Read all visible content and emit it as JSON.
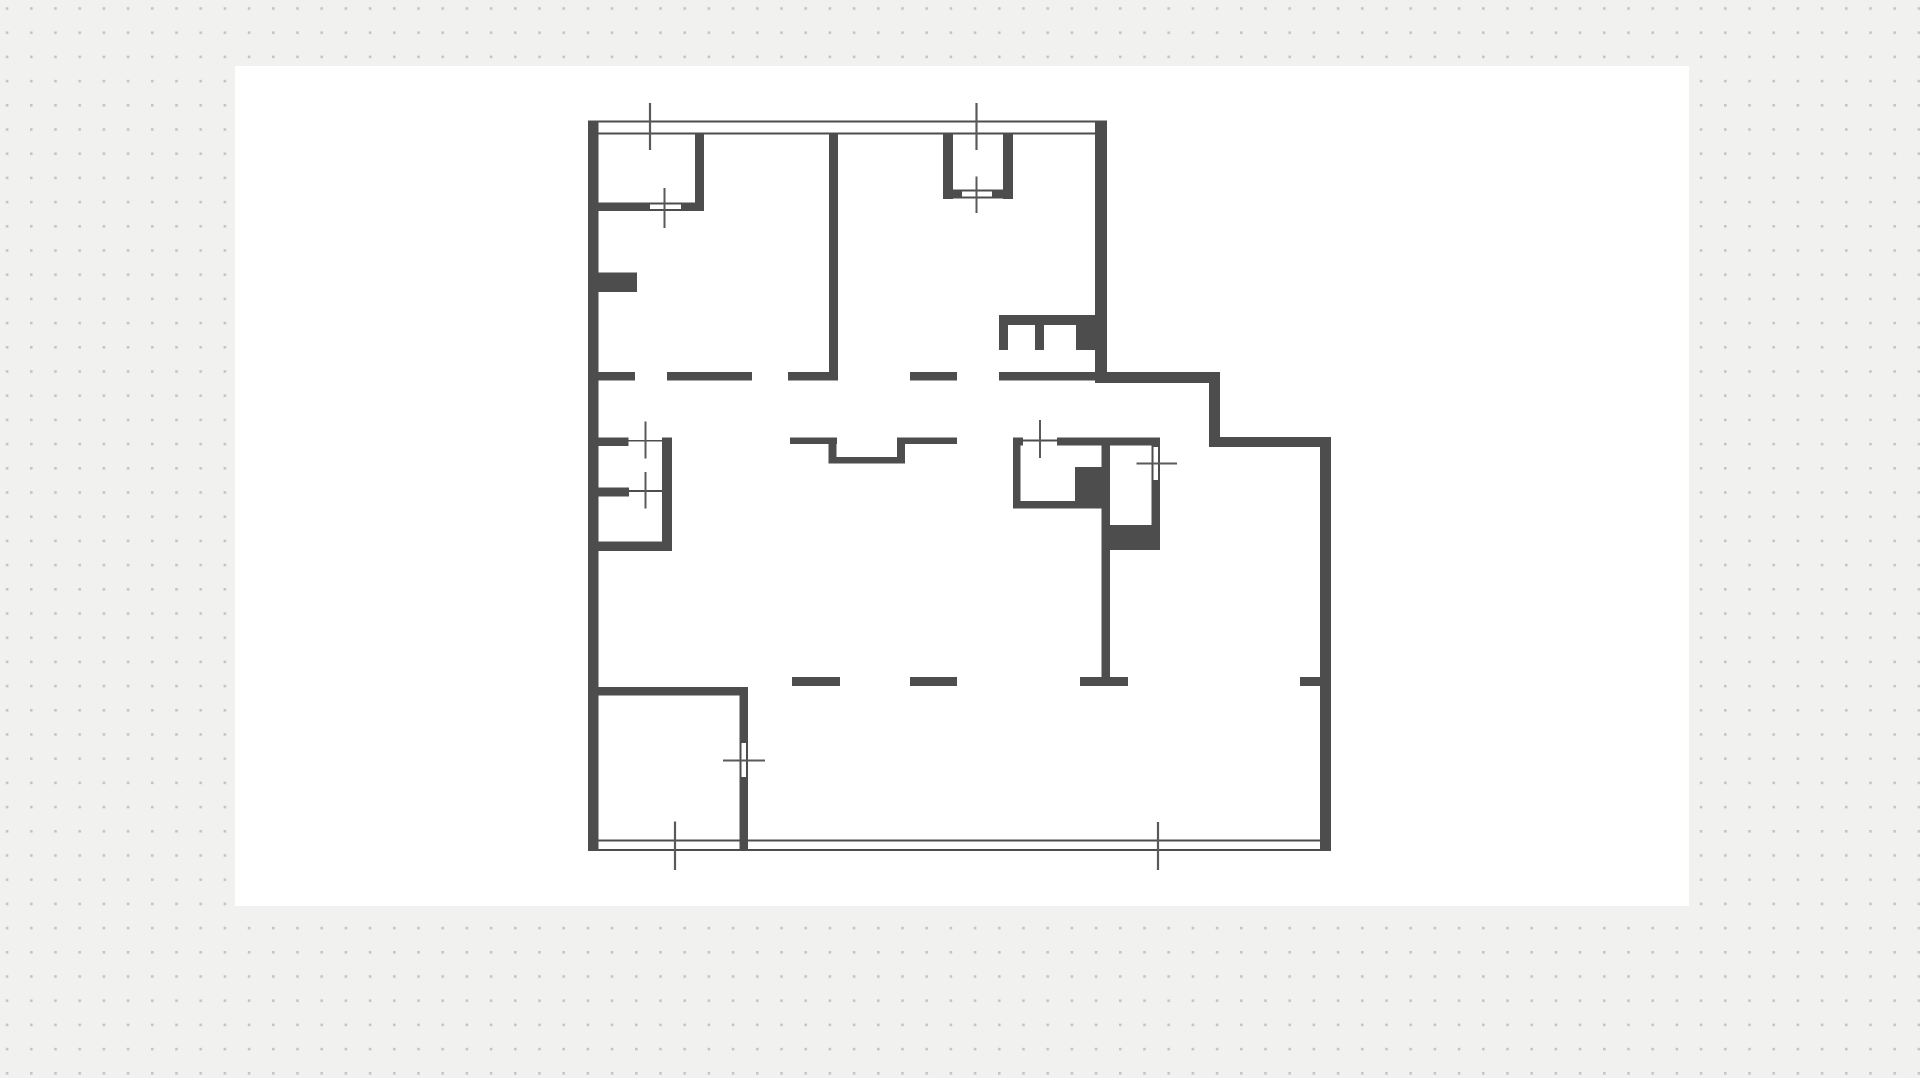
{
  "canvas": {
    "width": 1920,
    "height": 1078,
    "background_color": "#f1f1f0",
    "dot_grid": {
      "color": "#c4c4c4",
      "size": 2.6,
      "spacing": 24.2,
      "offset_x": 5.8,
      "offset_y": 7.2
    },
    "white_panel": {
      "x": 235,
      "y": 66,
      "w": 1454,
      "h": 840,
      "color": "#ffffff"
    }
  },
  "plan": {
    "wall_color": "#4d4d4d",
    "thin_color": "#4d4d4d",
    "tick_color": "#5a5a5a",
    "slot_fill": "#ffffff",
    "walls": [
      {
        "id": "exterior-left",
        "x": 588,
        "y": 120.5,
        "w": 10.5,
        "h": 730.5
      },
      {
        "id": "exterior-right-upper",
        "x": 1095,
        "y": 120.5,
        "w": 12,
        "h": 262.5
      },
      {
        "id": "step-top",
        "x": 1107,
        "y": 372,
        "w": 113,
        "h": 11
      },
      {
        "id": "step-side",
        "x": 1209,
        "y": 383,
        "w": 11,
        "h": 64
      },
      {
        "id": "step-top-2",
        "x": 1220,
        "y": 437,
        "w": 111,
        "h": 10
      },
      {
        "id": "exterior-right-lower",
        "x": 1320,
        "y": 437,
        "w": 11,
        "h": 413
      },
      {
        "id": "room1-right",
        "x": 695,
        "y": 133,
        "w": 9,
        "h": 78
      },
      {
        "id": "room1-bottom-a",
        "x": 598,
        "y": 202.5,
        "w": 52,
        "h": 8.5
      },
      {
        "id": "room1-bottom-b",
        "x": 681,
        "y": 202.5,
        "w": 23,
        "h": 8.5
      },
      {
        "id": "room2-left",
        "x": 943,
        "y": 133,
        "w": 10,
        "h": 66
      },
      {
        "id": "room2-right",
        "x": 1003,
        "y": 133,
        "w": 10,
        "h": 66
      },
      {
        "id": "room2-bottom-a",
        "x": 943,
        "y": 189.5,
        "w": 19,
        "h": 9
      },
      {
        "id": "room2-bottom-b",
        "x": 992,
        "y": 189.5,
        "w": 21,
        "h": 9
      },
      {
        "id": "interior-main",
        "x": 829,
        "y": 133,
        "w": 9,
        "h": 247
      },
      {
        "id": "pier",
        "x": 598,
        "y": 272.5,
        "w": 39,
        "h": 19.5
      },
      {
        "id": "dash1-a",
        "x": 598,
        "y": 372,
        "w": 37,
        "h": 8.5
      },
      {
        "id": "dash1-b",
        "x": 667,
        "y": 372,
        "w": 85,
        "h": 8.5
      },
      {
        "id": "dash1-c",
        "x": 788,
        "y": 372,
        "w": 50,
        "h": 8.5
      },
      {
        "id": "dash1-d",
        "x": 910,
        "y": 372,
        "w": 47,
        "h": 8.5
      },
      {
        "id": "dash1-e",
        "x": 999,
        "y": 372,
        "w": 96,
        "h": 8.5
      },
      {
        "id": "counter-top",
        "x": 999,
        "y": 315,
        "w": 98,
        "h": 10
      },
      {
        "id": "counter-stub-a",
        "x": 999,
        "y": 325,
        "w": 9,
        "h": 25
      },
      {
        "id": "counter-stub-b",
        "x": 1035,
        "y": 325,
        "w": 9,
        "h": 25
      },
      {
        "id": "counter-block",
        "x": 1076,
        "y": 325,
        "w": 21,
        "h": 25
      },
      {
        "id": "closet-top-a",
        "x": 598,
        "y": 437.5,
        "w": 30.5,
        "h": 8.5
      },
      {
        "id": "closet-top-b",
        "x": 662,
        "y": 437.5,
        "w": 10,
        "h": 8.5
      },
      {
        "id": "closet-mid",
        "x": 598,
        "y": 487.5,
        "w": 31,
        "h": 9
      },
      {
        "id": "closet-right",
        "x": 662,
        "y": 437.5,
        "w": 10,
        "h": 113.5
      },
      {
        "id": "closet-bottom",
        "x": 598,
        "y": 541.5,
        "w": 74,
        "h": 9.5
      },
      {
        "id": "bath-top-a",
        "x": 1013,
        "y": 437.5,
        "w": 10,
        "h": 8
      },
      {
        "id": "bath-top-b",
        "x": 1057,
        "y": 437.5,
        "w": 103,
        "h": 8
      },
      {
        "id": "bath-left",
        "x": 1013,
        "y": 437.5,
        "w": 7.5,
        "h": 70.5
      },
      {
        "id": "bath-bottom-left",
        "x": 1013,
        "y": 501,
        "w": 64,
        "h": 7.5
      },
      {
        "id": "bath-block",
        "x": 1075,
        "y": 467,
        "w": 27,
        "h": 41.5
      },
      {
        "id": "bath-mid",
        "x": 1101.5,
        "y": 445,
        "w": 8.5,
        "h": 80
      },
      {
        "id": "bath-bottom-block",
        "x": 1101.5,
        "y": 525,
        "w": 58.5,
        "h": 25
      },
      {
        "id": "bath-right-a",
        "x": 1151.5,
        "y": 437.5,
        "w": 8.5,
        "h": 9.5
      },
      {
        "id": "bath-right-b",
        "x": 1151.5,
        "y": 480,
        "w": 8.5,
        "h": 70
      },
      {
        "id": "partition-lower",
        "x": 1101.5,
        "y": 550,
        "w": 8.5,
        "h": 127
      },
      {
        "id": "tbar",
        "x": 1080,
        "y": 677,
        "w": 48,
        "h": 9
      },
      {
        "id": "dash2-a",
        "x": 792,
        "y": 677,
        "w": 48,
        "h": 9
      },
      {
        "id": "dash2-b",
        "x": 910,
        "y": 677,
        "w": 47,
        "h": 9
      },
      {
        "id": "dash2-stub",
        "x": 1300,
        "y": 677,
        "w": 20,
        "h": 9
      },
      {
        "id": "room3-top",
        "x": 588,
        "y": 687,
        "w": 160,
        "h": 8.5
      },
      {
        "id": "room3-right-a",
        "x": 739.5,
        "y": 687,
        "w": 8.5,
        "h": 56
      },
      {
        "id": "room3-right-b",
        "x": 739.5,
        "y": 777,
        "w": 8.5,
        "h": 74
      },
      {
        "id": "niche-top-left",
        "x": 790,
        "y": 437.5,
        "w": 47,
        "h": 6.5
      },
      {
        "id": "niche-left-v",
        "x": 828.5,
        "y": 437.5,
        "w": 8,
        "h": 26
      },
      {
        "id": "niche-bottom",
        "x": 828.5,
        "y": 457,
        "w": 76.5,
        "h": 6.5
      },
      {
        "id": "niche-right-v",
        "x": 897,
        "y": 437.5,
        "w": 8,
        "h": 26
      },
      {
        "id": "niche-top-right",
        "x": 897,
        "y": 437.5,
        "w": 60,
        "h": 6.5
      }
    ],
    "thin_lines": [
      {
        "id": "top-wall-outer",
        "x": 588,
        "y": 120.5,
        "w": 507,
        "h": 2
      },
      {
        "id": "top-wall-inner",
        "x": 598.5,
        "y": 132.5,
        "w": 496.5,
        "h": 2
      },
      {
        "id": "bottom-wall-inner",
        "x": 598.5,
        "y": 839.5,
        "w": 721.5,
        "h": 2
      },
      {
        "id": "bottom-wall-outer",
        "x": 588,
        "y": 848.8,
        "w": 743,
        "h": 2.2
      }
    ],
    "openings": [
      {
        "id": "room1-door",
        "x": 650,
        "y": 202.5,
        "w": 31,
        "h": 8.5,
        "style": "door-h",
        "tick": {
          "x": 664.5,
          "y": 188,
          "len": 40,
          "dir": "v"
        }
      },
      {
        "id": "room2-door",
        "x": 962,
        "y": 189.5,
        "w": 30,
        "h": 9,
        "style": "door-h",
        "tick": {
          "x": 976.5,
          "y": 176.5,
          "len": 36.5,
          "dir": "v"
        }
      },
      {
        "id": "closet-window-top",
        "x": 628.5,
        "y": 437.5,
        "w": 33.5,
        "h": 8.5,
        "style": "glass-h",
        "tick": {
          "x": 645.5,
          "y": 421.5,
          "len": 37,
          "dir": "v"
        }
      },
      {
        "id": "closet-window-mid",
        "x": 629,
        "y": 487.5,
        "w": 33,
        "h": 9,
        "style": "glass-h",
        "tick": {
          "x": 645.5,
          "y": 472,
          "len": 36.5,
          "dir": "v"
        }
      },
      {
        "id": "bath-window",
        "x": 1023,
        "y": 437.5,
        "w": 34,
        "h": 8,
        "style": "glass-h",
        "tick": {
          "x": 1040,
          "y": 420,
          "len": 38,
          "dir": "v"
        }
      },
      {
        "id": "bath-door",
        "x": 1151.5,
        "y": 447,
        "w": 8.5,
        "h": 33,
        "style": "door-v",
        "tick": {
          "x": 1136.5,
          "y": 463.5,
          "len": 40.5,
          "dir": "h"
        }
      },
      {
        "id": "room3-door",
        "x": 739.5,
        "y": 743,
        "w": 8.5,
        "h": 34,
        "style": "door-v",
        "tick": {
          "x": 723,
          "y": 760.5,
          "len": 42,
          "dir": "h"
        }
      }
    ],
    "wall_ticks": [
      {
        "id": "top-wall-tick-left",
        "x": 650,
        "y": 103,
        "len": 47,
        "dir": "v"
      },
      {
        "id": "top-wall-tick-right",
        "x": 976.5,
        "y": 103,
        "len": 47,
        "dir": "v"
      },
      {
        "id": "bottom-wall-tick-left",
        "x": 675,
        "y": 821.5,
        "len": 48.5,
        "dir": "v"
      },
      {
        "id": "bottom-wall-tick-right",
        "x": 1158,
        "y": 822,
        "len": 48,
        "dir": "v"
      }
    ]
  }
}
